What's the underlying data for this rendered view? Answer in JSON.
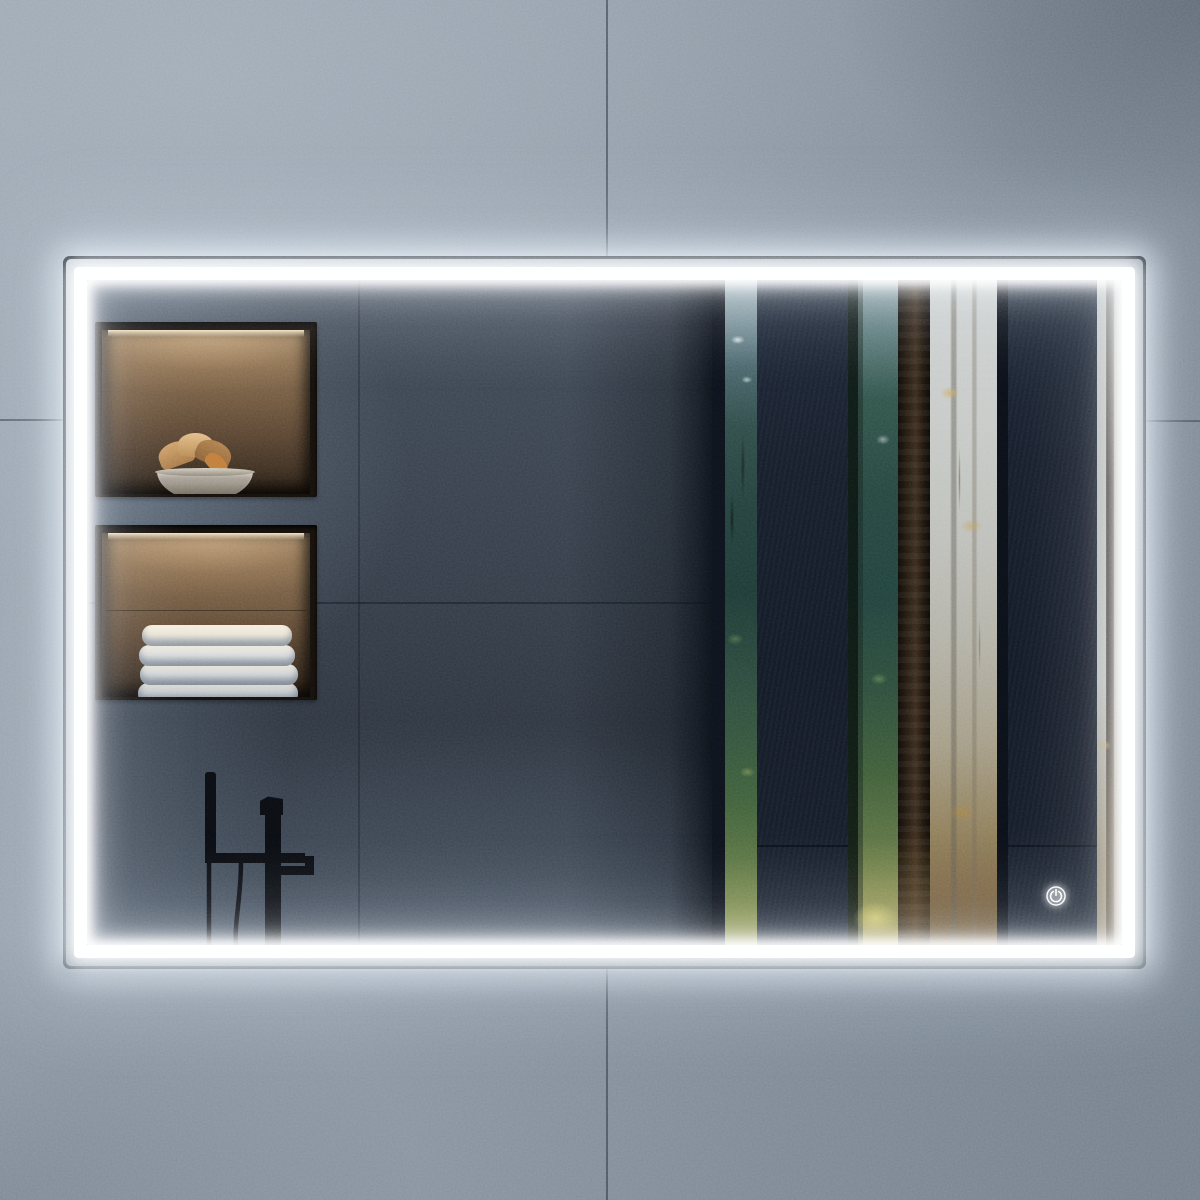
{
  "scene": {
    "type": "product-photo",
    "subject": "Rectangular LED-backlit bathroom mirror mounted on a concrete tile wall",
    "wall": {
      "name": "concrete-tile-wall",
      "color": "#8d97a3",
      "seam_color": "#3e4854"
    },
    "mirror": {
      "name": "led-mirror",
      "frame_color": "#3a424c",
      "led_color": "#ffffff",
      "power_button": {
        "icon": "power-icon",
        "label": "power",
        "glow_color": "#ffffff"
      }
    },
    "reflection": {
      "wall_color": "#333b46",
      "niche_decor": {
        "items": [
          "stone-bowl",
          "dried-flowers"
        ],
        "light_color": "#e8c89a",
        "bowl_color": "#9d968a",
        "flower_color": "#c9995c"
      },
      "niche_towels": {
        "items": [
          "folded-towels"
        ],
        "towel_count": 4,
        "towel_color": "#e6e8e7"
      },
      "faucet": {
        "name": "black-freestanding-faucet",
        "color": "#0a0c10"
      },
      "window": {
        "name": "slatted-forest-view",
        "slat_color": "#151b25",
        "forest_green": "#2e4a40",
        "mist_color": "#c3c8c7",
        "autumn_color": "#b98447"
      }
    }
  }
}
